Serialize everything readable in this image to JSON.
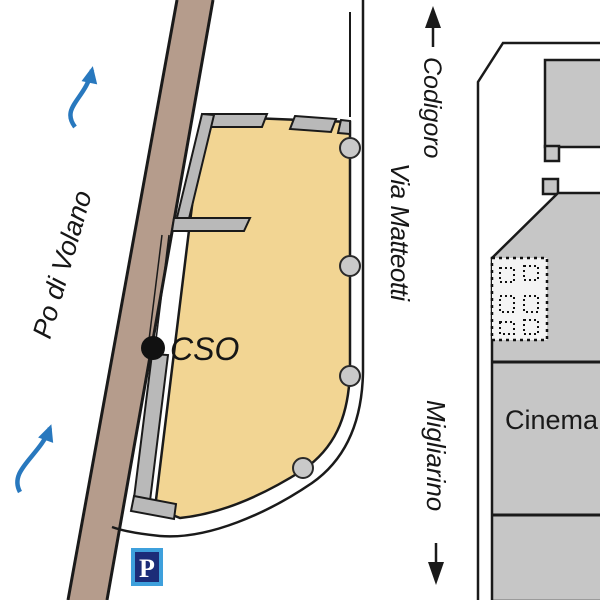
{
  "map": {
    "river_label": "Po di Volano",
    "site_label": "CSO",
    "street_label": "Via Matteotti",
    "direction_north_label": "Codigoro",
    "direction_south_label": "Migliarino",
    "cinema_label": "Cinema",
    "parking_label": "P"
  },
  "colors": {
    "parcel_tan": "#f2d593",
    "embankment_brown": "#b59c8c",
    "wall_gray": "#b9b9b9",
    "building_gray": "#c6c6c6",
    "tree_gray": "#c9c9c9",
    "dotted_area_fill": "#f4f4f4",
    "river_arrow_blue": "#2878be",
    "parking_border_blue": "#3ea0dc",
    "parking_fill_blue": "#1c2c78",
    "outline_black": "#1a1a1a"
  }
}
